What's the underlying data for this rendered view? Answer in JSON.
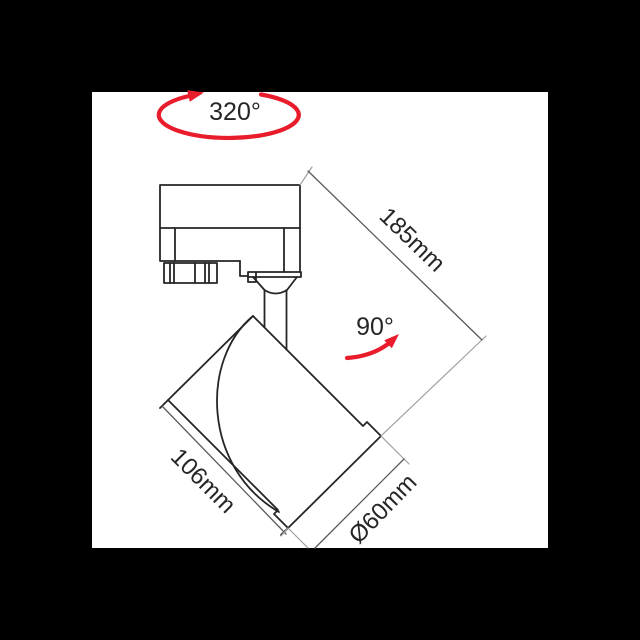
{
  "page": {
    "background": "#000000"
  },
  "panel": {
    "background": "#ffffff"
  },
  "colors": {
    "accent_red": "#e81c2b",
    "drawing_line": "#262626",
    "dimension_line": "#5a5a5a",
    "extension_line": "#a0a0a0",
    "label_text": "#262626"
  },
  "diagram": {
    "type": "product-dimension-drawing",
    "subject": "track-spotlight-fixture",
    "labels": {
      "rotation_range": "320°",
      "tilt_angle": "90°",
      "overall_length": "185mm",
      "head_length": "106mm",
      "head_diameter": "Ø60mm"
    }
  }
}
